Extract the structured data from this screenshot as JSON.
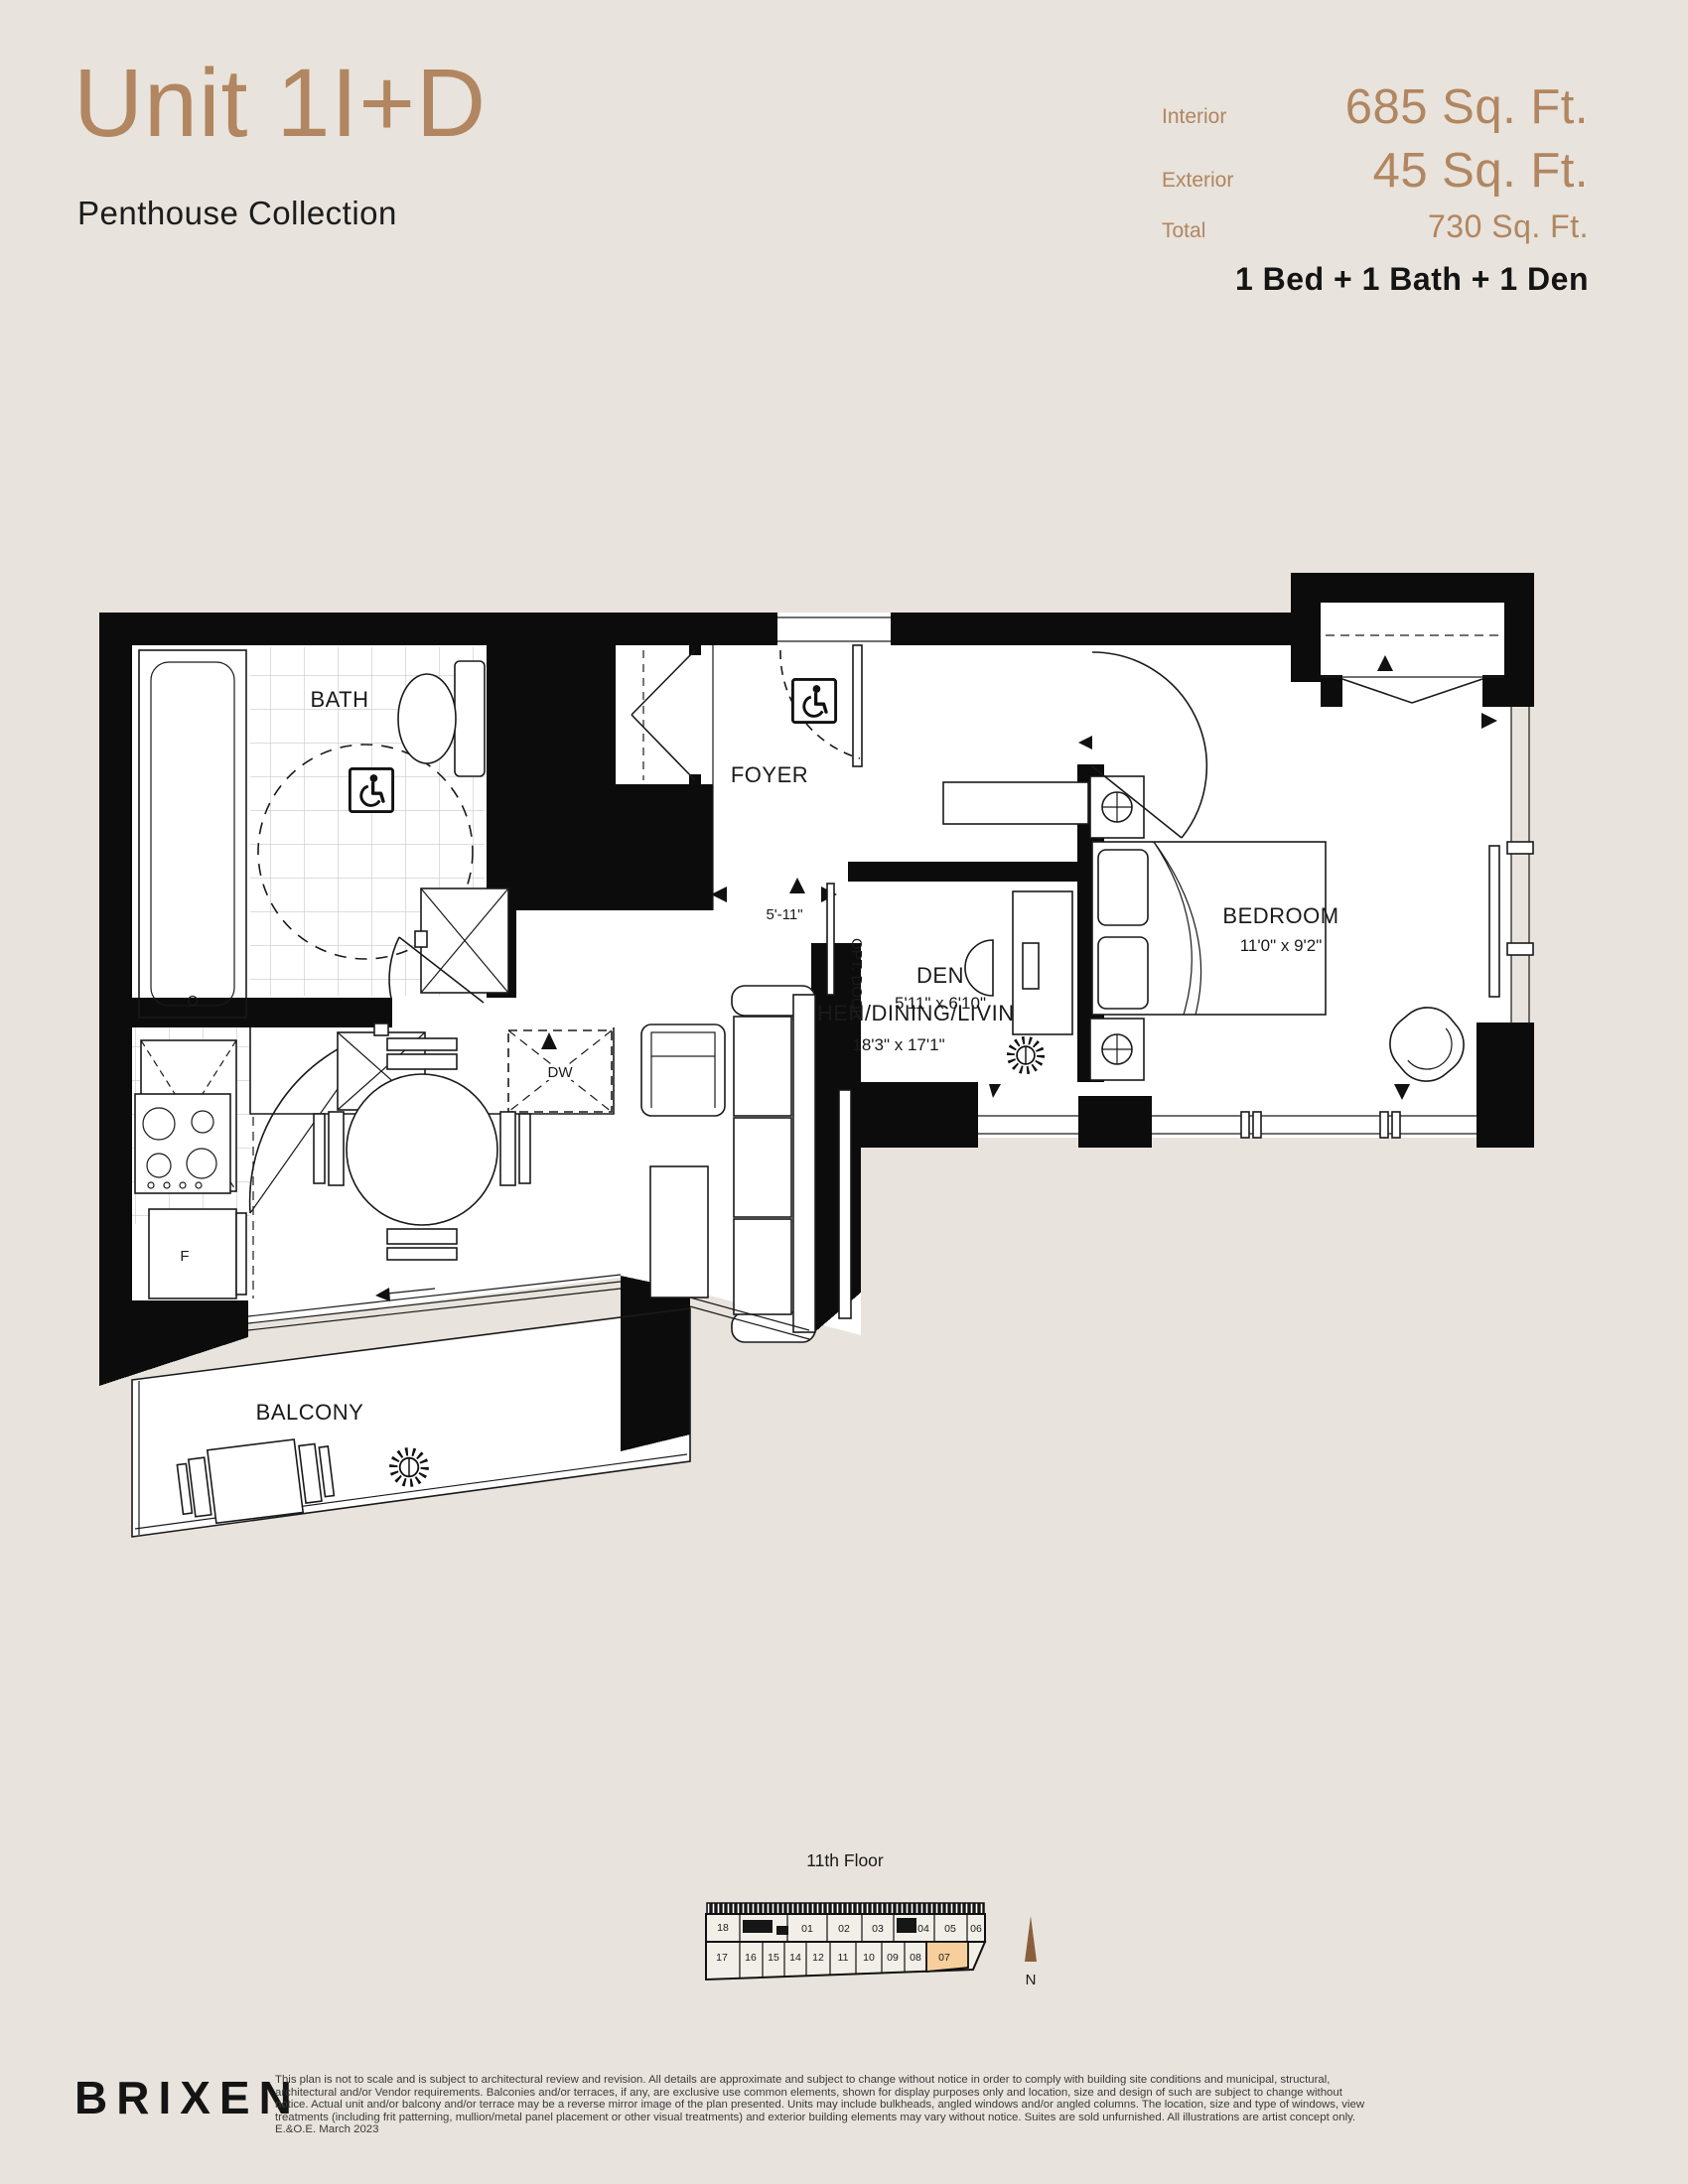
{
  "header": {
    "unit_title": "Unit 1I+D",
    "collection": "Penthouse Collection",
    "stats": [
      {
        "label": "Interior",
        "value": "685 Sq. Ft."
      },
      {
        "label": "Exterior",
        "value": "45 Sq. Ft."
      },
      {
        "label": "Total",
        "value": "730 Sq. Ft."
      }
    ],
    "configuration": "1 Bed + 1 Bath + 1 Den"
  },
  "floorplan": {
    "labels": {
      "bath": "BATH",
      "foyer": "FOYER",
      "wd": "W/D",
      "dw": "DW",
      "fridge": "F",
      "kitchen": "KITCHEN/DINING/LIVING",
      "kitchen_dims": "18'3\" x 17'1\"",
      "den": "DEN",
      "den_dims": "5'11\" x 6'10\"",
      "den_opening_dim": "5'-11\"",
      "opt_door": "OPT. DOOR",
      "bedroom": "BEDROOM",
      "bedroom_dims": "11'0\" x 9'2\"",
      "balcony": "BALCONY"
    }
  },
  "keyplan": {
    "floor_label": "11th Floor",
    "north_label": "N",
    "units_top": [
      "18",
      "01",
      "02",
      "03",
      "04",
      "05",
      "06"
    ],
    "units_bottom": [
      "17",
      "16",
      "15",
      "14",
      "12",
      "11",
      "10",
      "09",
      "08",
      "07"
    ],
    "highlighted_unit": "07",
    "highlight_color": "#f6cf9d"
  },
  "footer": {
    "logo": "BRIXEN",
    "disclaimer_lines": [
      "This plan is not to scale and is subject to architectural review and revision. All details are approximate and subject to change without notice in order to comply with building site conditions and municipal, structural,",
      "architectural and/or Vendor requirements. Balconies and/or terraces, if any, are exclusive use common elements, shown for display purposes only and location, size and design of such are subject to change without",
      "notice. Actual unit and/or balcony and/or terrace may be a reverse mirror image of the plan presented. Units may include bulkheads, angled windows and/or angled columns. The location, size and type of windows, view",
      "treatments (including frit patterning, mullion/metal panel placement or other visual treatments) and exterior building elements may vary without notice. Suites are sold unfurnished. All illustrations are artist concept only.",
      "E.&O.E. March 2023"
    ]
  },
  "colors": {
    "accent_brown": "#b18660",
    "background": "#e8e3dc",
    "wall_black": "#0c0c0c",
    "north_arrow": "#8a5f3d"
  }
}
